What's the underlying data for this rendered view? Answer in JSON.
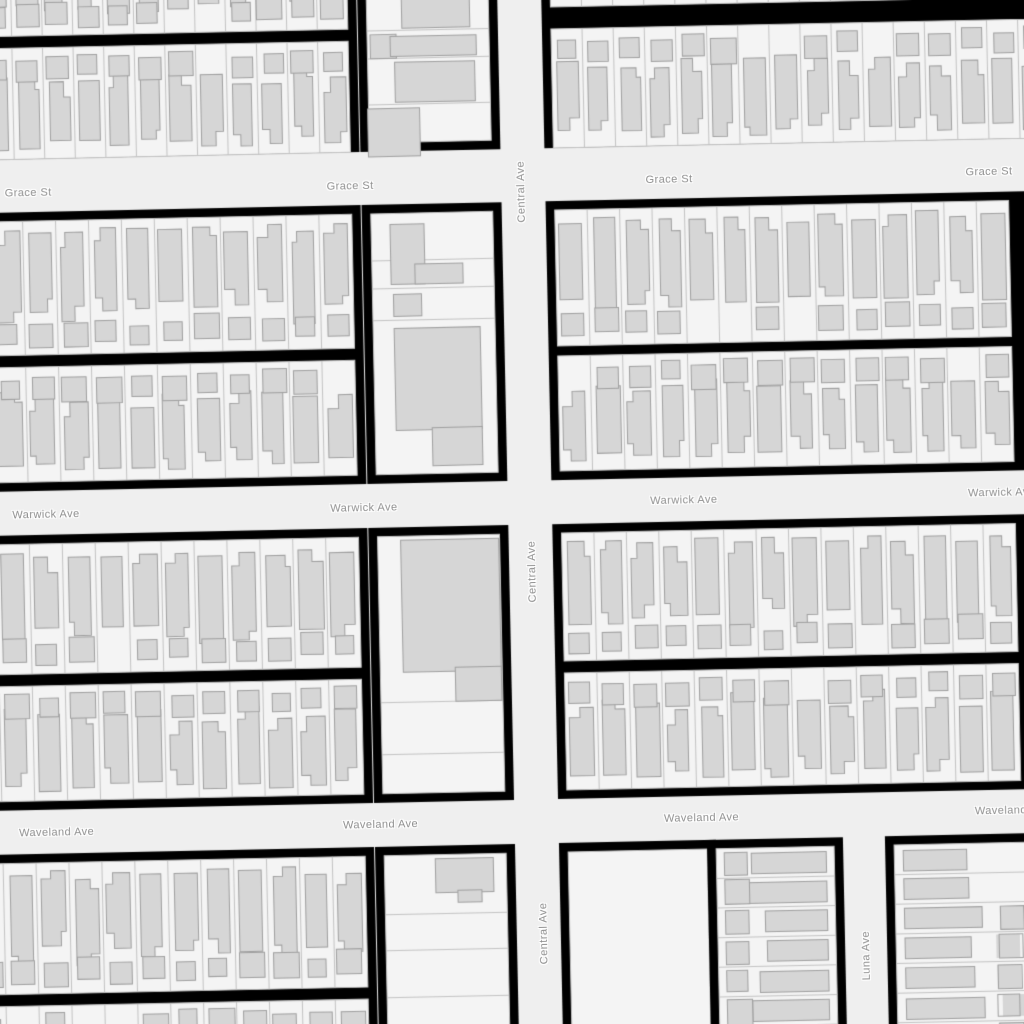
{
  "app": {
    "kind": "street-map-view"
  },
  "streets": {
    "horizontal": [
      "Grace St",
      "Warwick Ave",
      "Waveland Ave"
    ],
    "vertical": [
      "Central Ave",
      "Luna Ave"
    ]
  },
  "labels": [
    {
      "text": "Grace St",
      "x": 35,
      "y": 183,
      "vertical": false
    },
    {
      "text": "Grace St",
      "x": 357,
      "y": 183,
      "vertical": false
    },
    {
      "text": "Grace St",
      "x": 676,
      "y": 183,
      "vertical": false
    },
    {
      "text": "Grace St",
      "x": 996,
      "y": 182,
      "vertical": false
    },
    {
      "text": "Warwick Ave",
      "x": 46,
      "y": 505,
      "vertical": false
    },
    {
      "text": "Warwick Ave",
      "x": 364,
      "y": 505,
      "vertical": false
    },
    {
      "text": "Warwick Ave",
      "x": 684,
      "y": 504,
      "vertical": false
    },
    {
      "text": "Warwick Ave",
      "x": 1002,
      "y": 503,
      "vertical": false
    },
    {
      "text": "Waveland Ave",
      "x": 50,
      "y": 823,
      "vertical": false
    },
    {
      "text": "Waveland Ave",
      "x": 374,
      "y": 822,
      "vertical": false
    },
    {
      "text": "Waveland Ave",
      "x": 695,
      "y": 822,
      "vertical": false
    },
    {
      "text": "Waveland Ave",
      "x": 1006,
      "y": 821,
      "vertical": false
    },
    {
      "text": "Central Ave",
      "x": 528,
      "y": 192,
      "vertical": true
    },
    {
      "text": "Central Ave",
      "x": 531,
      "y": 572,
      "vertical": true
    },
    {
      "text": "Central Ave",
      "x": 535,
      "y": 934,
      "vertical": true
    },
    {
      "text": "Luna Ave",
      "x": 857,
      "y": 963,
      "vertical": true
    }
  ],
  "colors": {
    "road": "#efefef",
    "block_border": "#000000",
    "lot_fill": "#f4f4f4",
    "lot_stroke": "#c3c3c3",
    "building_fill": "#d6d6d6",
    "building_stroke": "#9f9f9f",
    "label_text": "#8e8e8e",
    "label_halo": "#ffffff"
  },
  "map": {
    "width": 1024,
    "height": 1024,
    "rotation_deg": -1.2,
    "seed": 11,
    "roads": {
      "horizontal": [
        {
          "name": "Grace St",
          "top": 158,
          "bottom": 202
        },
        {
          "name": "Warwick Ave",
          "top": 481,
          "bottom": 525
        },
        {
          "name": "Waveland Ave",
          "top": 800,
          "bottom": 844
        }
      ],
      "vertical": [
        {
          "name": "Central Ave",
          "left": 508,
          "right": 552,
          "from": -80,
          "to": 1100
        },
        {
          "name": "Luna Ave",
          "left": 836,
          "right": 878,
          "from": 844,
          "to": 1100
        }
      ]
    },
    "sections": [
      {
        "x0": -80,
        "x1": 367,
        "y0": -80,
        "y1": 149,
        "bands": [
          {
            "kind": "res",
            "x0": -70,
            "x1": 358,
            "y0": -70,
            "y1": 26,
            "houses": "top",
            "pitch": 31
          },
          {
            "kind": "res",
            "x0": -70,
            "x1": 358,
            "y0": 38,
            "y1": 149,
            "houses": "bottom",
            "pitch": 31
          }
        ]
      },
      {
        "x0": -80,
        "x1": 367,
        "y0": 202,
        "y1": 481,
        "bands": [
          {
            "kind": "res",
            "x0": -70,
            "x1": 358,
            "y0": 211,
            "y1": 345,
            "houses": "top",
            "pitch": 32
          },
          {
            "kind": "res",
            "x0": -70,
            "x1": 358,
            "y0": 357,
            "y1": 472,
            "houses": "bottom",
            "pitch": 32
          }
        ]
      },
      {
        "x0": -80,
        "x1": 367,
        "y0": 525,
        "y1": 800,
        "bands": [
          {
            "kind": "res",
            "x0": -70,
            "x1": 358,
            "y0": 534,
            "y1": 664,
            "houses": "top",
            "pitch": 33
          },
          {
            "kind": "res",
            "x0": -70,
            "x1": 358,
            "y0": 676,
            "y1": 791,
            "houses": "bottom",
            "pitch": 33
          }
        ]
      },
      {
        "x0": -80,
        "x1": 367,
        "y0": 844,
        "y1": 1100,
        "bands": [
          {
            "kind": "res",
            "x0": -70,
            "x1": 358,
            "y0": 853,
            "y1": 984,
            "houses": "top",
            "pitch": 32
          },
          {
            "kind": "res",
            "x0": -70,
            "x1": 358,
            "y0": 996,
            "y1": 1110,
            "houses": "bottom",
            "pitch": 32
          }
        ]
      },
      {
        "x0": 368,
        "x1": 508,
        "y0": -80,
        "y1": 149,
        "bands": [
          {
            "kind": "commercial",
            "x0": 377,
            "x1": 499,
            "y0": -70,
            "y1": 140,
            "hlines": [
              28,
              56,
              102
            ],
            "vlines": [],
            "buildings": [
              {
                "x": 412,
                "y": -30,
                "w": 68,
                "h": 56
              },
              {
                "x": 380,
                "y": 32,
                "w": 26,
                "h": 24
              },
              {
                "x": 400,
                "y": 34,
                "w": 86,
                "h": 20
              },
              {
                "x": 404,
                "y": 60,
                "w": 80,
                "h": 40
              },
              {
                "x": 376,
                "y": 106,
                "w": 52,
                "h": 48
              }
            ]
          }
        ]
      },
      {
        "x0": 368,
        "x1": 508,
        "y0": 202,
        "y1": 481,
        "bands": [
          {
            "kind": "commercial",
            "x0": 377,
            "x1": 499,
            "y0": 211,
            "y1": 472,
            "hlines": [
              258,
              286,
              318
            ],
            "vlines": [],
            "buildings": [
              {
                "x": 396,
                "y": 222,
                "w": 34,
                "h": 60
              },
              {
                "x": 420,
                "y": 262,
                "w": 48,
                "h": 20
              },
              {
                "x": 398,
                "y": 292,
                "w": 28,
                "h": 22
              },
              {
                "x": 398,
                "y": 326,
                "w": 86,
                "h": 102
              },
              {
                "x": 434,
                "y": 426,
                "w": 50,
                "h": 38
              }
            ]
          }
        ]
      },
      {
        "x0": 368,
        "x1": 508,
        "y0": 525,
        "y1": 800,
        "bands": [
          {
            "kind": "commercial",
            "x0": 377,
            "x1": 499,
            "y0": 534,
            "y1": 791,
            "hlines": [
              700,
              752
            ],
            "vlines": [],
            "buildings": [
              {
                "x": 400,
                "y": 538,
                "w": 98,
                "h": 132
              },
              {
                "x": 452,
                "y": 666,
                "w": 46,
                "h": 34
              }
            ]
          }
        ]
      },
      {
        "x0": 368,
        "x1": 508,
        "y0": 844,
        "y1": 1100,
        "bands": [
          {
            "kind": "commercial",
            "x0": 377,
            "x1": 499,
            "y0": 853,
            "y1": 1090,
            "hlines": [
              912,
              948,
              995
            ],
            "vlines": [],
            "buildings": [
              {
                "x": 428,
                "y": 857,
                "w": 58,
                "h": 34
              },
              {
                "x": 450,
                "y": 889,
                "w": 24,
                "h": 12
              }
            ]
          }
        ]
      },
      {
        "x0": 552,
        "x1": 1100,
        "y0": -80,
        "y1": 149,
        "bands": [
          {
            "kind": "res",
            "x0": 561,
            "x1": 1090,
            "y0": -70,
            "y1": 8,
            "houses": "top",
            "pitch": 32
          },
          {
            "kind": "res",
            "x0": 561,
            "x1": 1090,
            "y0": 30,
            "y1": 149,
            "houses": "bottom",
            "pitch": 32
          }
        ]
      },
      {
        "x0": 552,
        "x1": 1100,
        "y0": 202,
        "y1": 481,
        "bands": [
          {
            "kind": "res",
            "x0": 561,
            "x1": 1015,
            "y0": 211,
            "y1": 347,
            "houses": "top",
            "pitch": 33
          },
          {
            "kind": "res",
            "x0": 561,
            "x1": 1015,
            "y0": 357,
            "y1": 472,
            "houses": "bottom",
            "pitch": 33
          }
        ]
      },
      {
        "x0": 552,
        "x1": 1100,
        "y0": 525,
        "y1": 800,
        "bands": [
          {
            "kind": "res",
            "x0": 561,
            "x1": 1015,
            "y0": 534,
            "y1": 662,
            "houses": "top",
            "pitch": 33
          },
          {
            "kind": "res",
            "x0": 561,
            "x1": 1015,
            "y0": 674,
            "y1": 791,
            "houses": "bottom",
            "pitch": 33
          }
        ]
      },
      {
        "x0": 552,
        "x1": 709,
        "y0": 844,
        "y1": 1100,
        "bands": [
          {
            "kind": "empty",
            "x0": 561,
            "x1": 700,
            "y0": 853,
            "y1": 1090
          }
        ]
      },
      {
        "x0": 700,
        "x1": 836,
        "y0": 844,
        "y1": 1100,
        "bands": [
          {
            "kind": "hrows",
            "x0": 709,
            "x1": 827,
            "y0": 853,
            "y1": 1090,
            "house_side": "right",
            "pitch": 30
          }
        ]
      },
      {
        "x0": 878,
        "x1": 1100,
        "y0": 844,
        "y1": 1100,
        "bands": [
          {
            "kind": "hrows",
            "x0": 887,
            "x1": 1075,
            "y0": 853,
            "y1": 1090,
            "house_side": "left",
            "pitch": 30
          }
        ]
      }
    ]
  }
}
